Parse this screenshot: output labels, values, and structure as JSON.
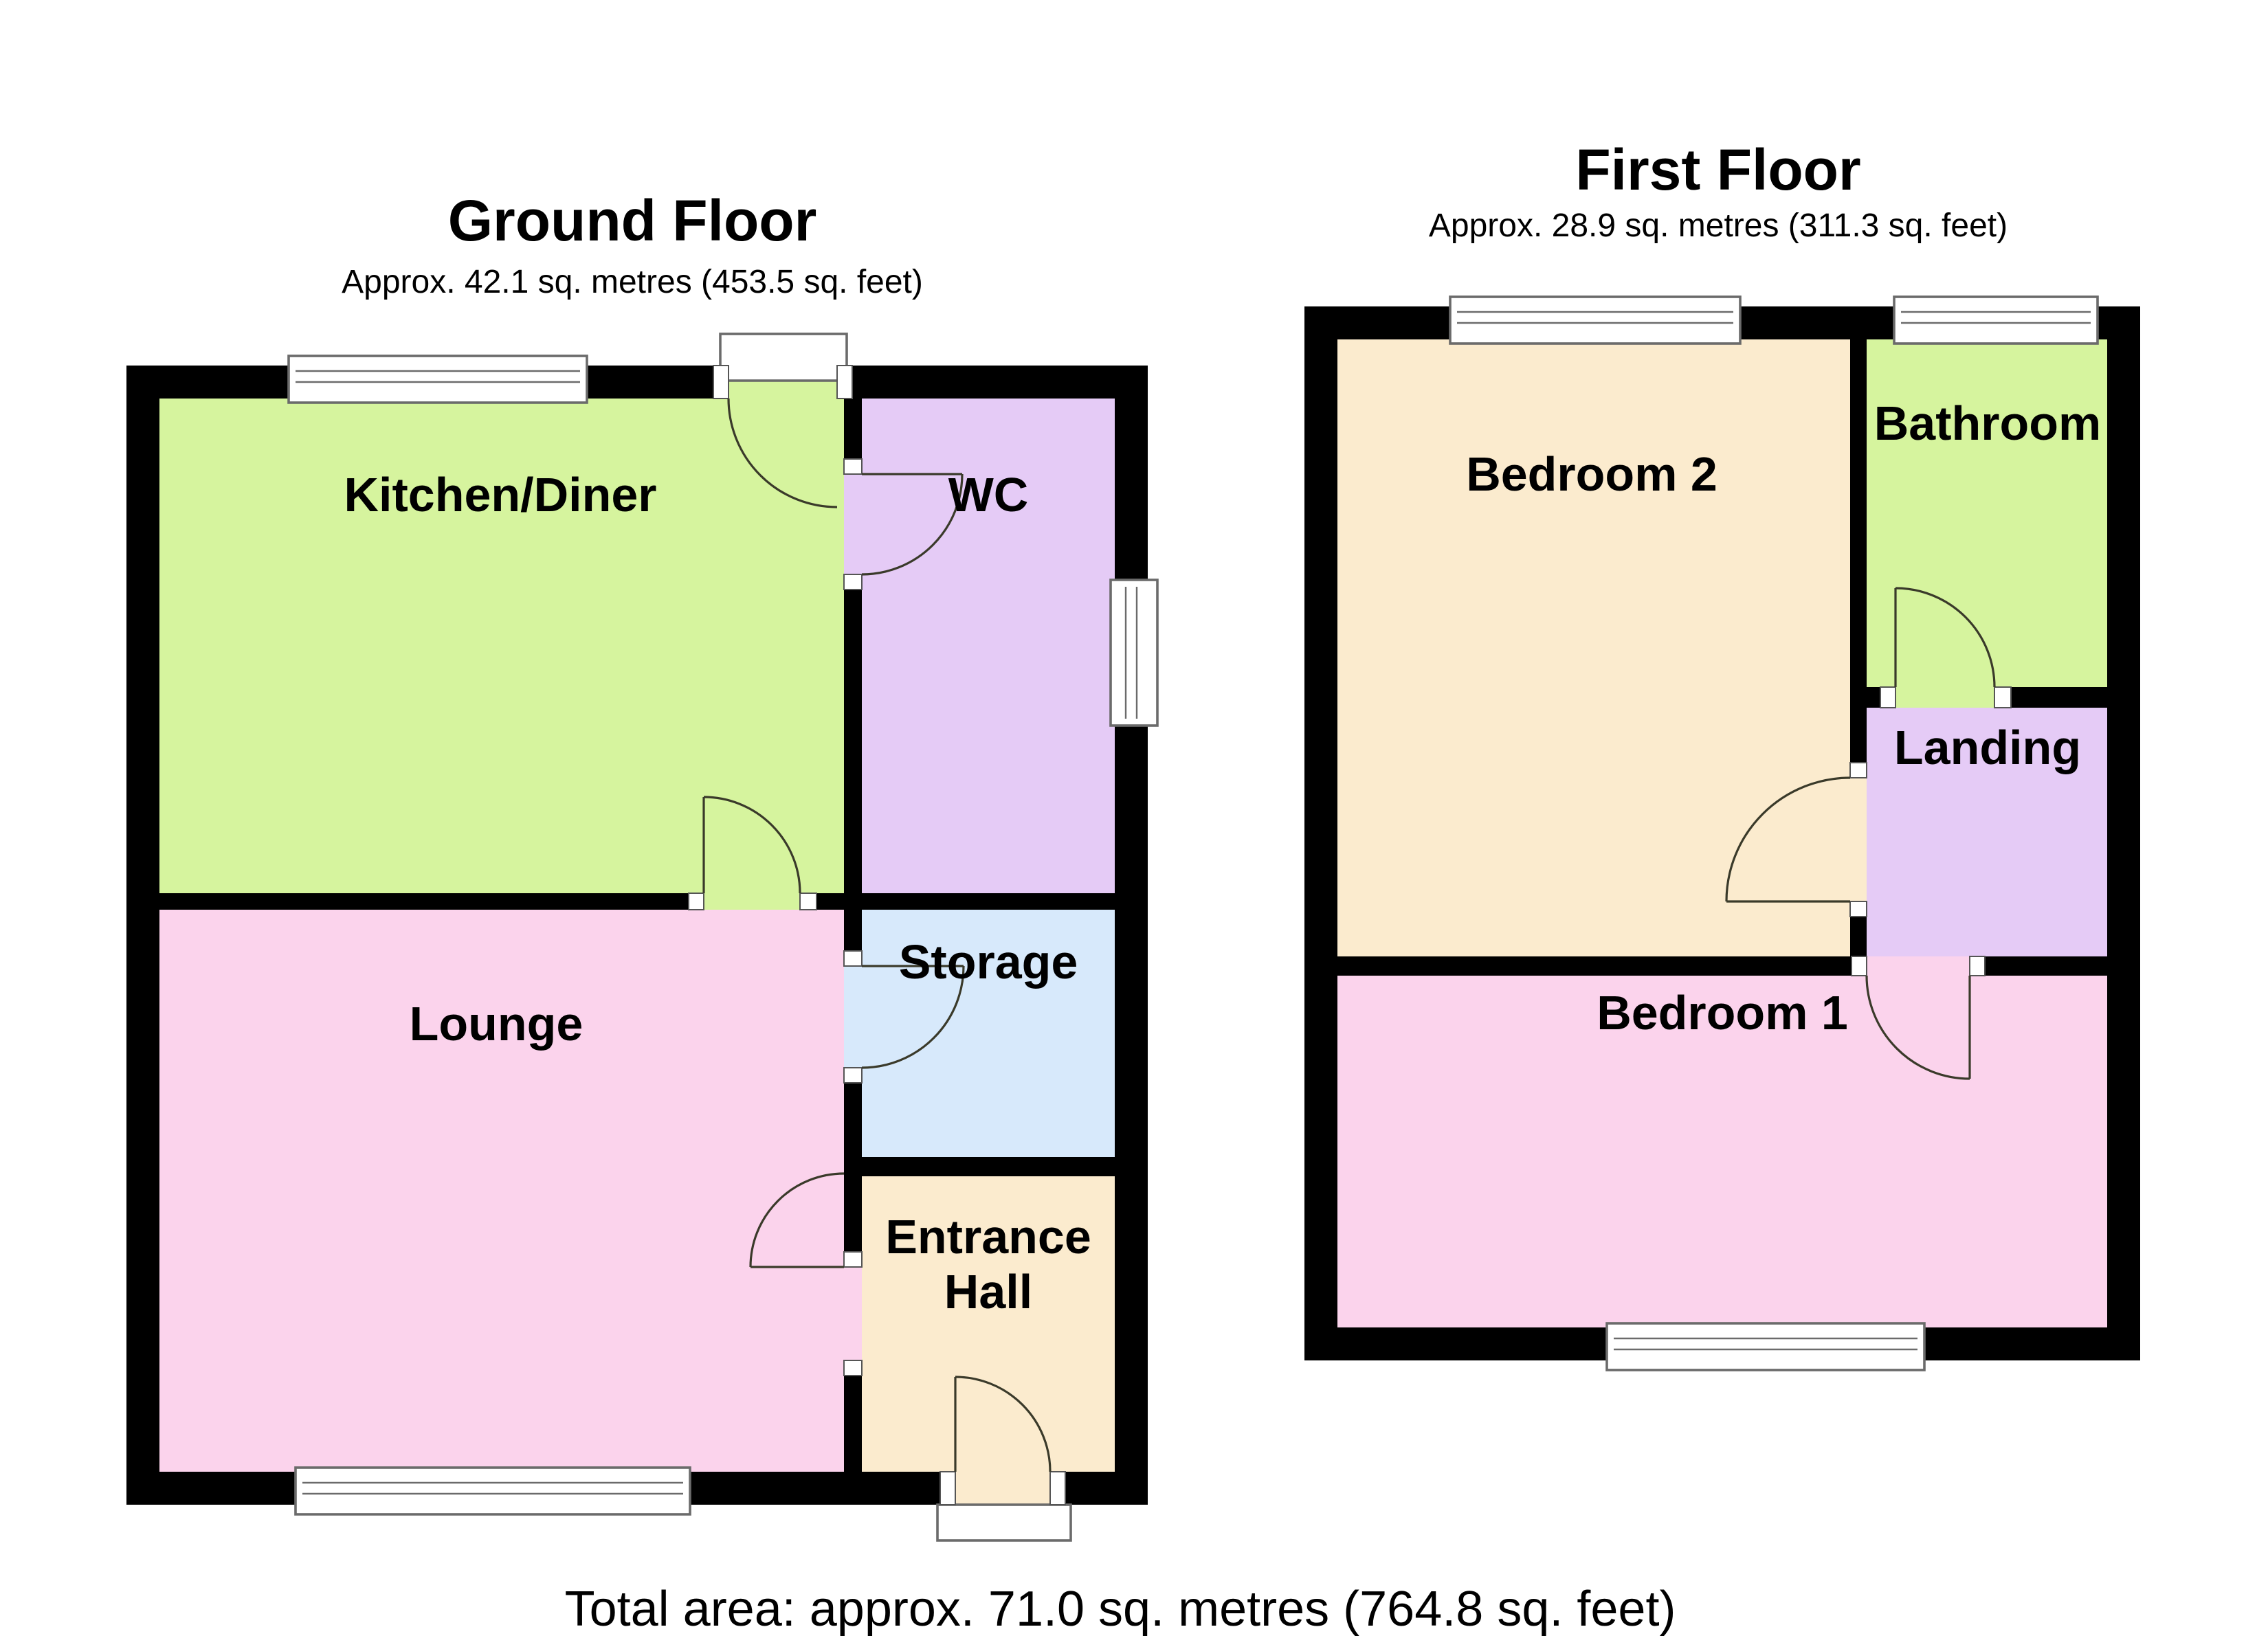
{
  "ground_floor": {
    "title": "Ground Floor",
    "subtitle": "Approx. 42.1 sq. metres (453.5 sq. feet)",
    "rooms": {
      "kitchen_diner": {
        "label": "Kitchen/Diner"
      },
      "wc": {
        "label": "WC"
      },
      "lounge": {
        "label": "Lounge"
      },
      "storage": {
        "label": "Storage"
      },
      "entrance_hall": {
        "label": "Entrance Hall",
        "lines": [
          "Entrance",
          "Hall"
        ]
      }
    }
  },
  "first_floor": {
    "title": "First Floor",
    "subtitle": "Approx. 28.9 sq. metres (311.3 sq. feet)",
    "rooms": {
      "bedroom2": {
        "label": "Bedroom 2"
      },
      "bathroom": {
        "label": "Bathroom"
      },
      "landing": {
        "label": "Landing"
      },
      "bedroom1": {
        "label": "Bedroom 1"
      }
    }
  },
  "footer": {
    "total_area": "Total area: approx. 71.0 sq. metres (764.8 sq. feet)"
  },
  "colors": {
    "wall": "#000000",
    "green": "#D6F49E",
    "purple": "#E5CBF6",
    "pink": "#FBD3EC",
    "blue": "#D7E9FB",
    "cream": "#FBEBCE"
  }
}
